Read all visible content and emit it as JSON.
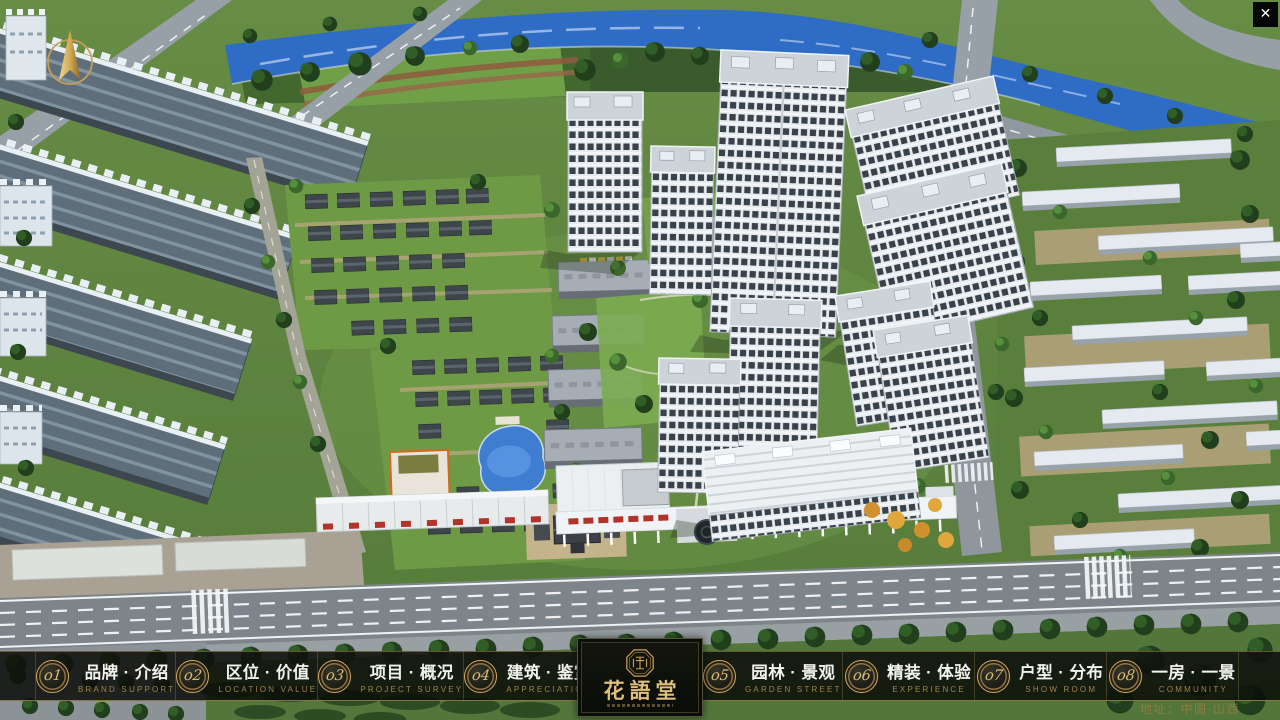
{
  "navbar": {
    "items": [
      {
        "number": "o1",
        "label": "品牌 · 介绍",
        "sublabel": "BRAND SUPPORT"
      },
      {
        "number": "o2",
        "label": "区位 · 价值",
        "sublabel": "LOCATION VALUE"
      },
      {
        "number": "o3",
        "label": "项目 · 概况",
        "sublabel": "PROJECT SURVEY"
      },
      {
        "number": "o4",
        "label": "建筑 · 鉴赏",
        "sublabel": "APPRECIATION"
      },
      {
        "number": "o5",
        "label": "园林 · 景观",
        "sublabel": "GARDEN STREET"
      },
      {
        "number": "o6",
        "label": "精装 · 体验",
        "sublabel": "EXPERIENCE"
      },
      {
        "number": "o7",
        "label": "户型 · 分布",
        "sublabel": "SHOW ROOM"
      },
      {
        "number": "o8",
        "label": "一房 · 一景",
        "sublabel": "COMMUNITY"
      }
    ]
  },
  "logo": {
    "title": "花語堂"
  },
  "footer": {
    "address": "地址：中国·山西"
  },
  "window": {
    "close_glyph": "✕"
  },
  "colors": {
    "gold": "#c9a96a",
    "gold_dim": "#9c8148",
    "nav_text": "#f2f2ee"
  }
}
